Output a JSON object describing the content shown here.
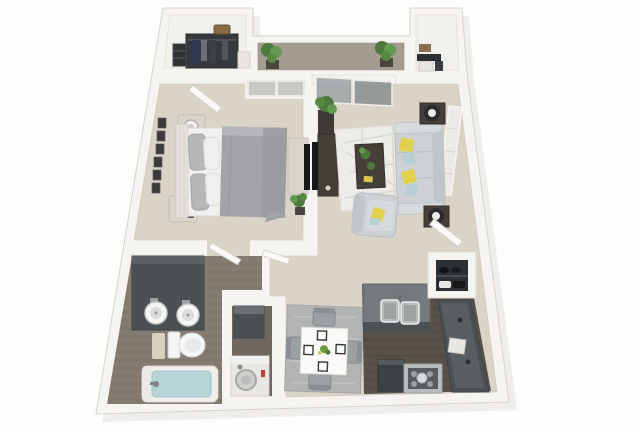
{
  "meta": {
    "description": "3D rendered top-down floor plan of a one-bedroom, one-bathroom apartment with balcony, open living-dining area and U-shaped kitchen",
    "render_style": "photoreal 3D dollhouse floor plan, no visible text"
  },
  "colors": {
    "page_bg": "#fdfdfd",
    "shadow": "#e4e2df",
    "wall": "#f6f4f0",
    "wall_line": "#d7d2cb",
    "floor_main": "#dad3c8",
    "floor_balcony": "#a49c91",
    "floor_bath": "#847c72",
    "floor_bath_line": "#746c62",
    "floor_kitchen": "#57514a",
    "floor_kitchen_line": "#49443e",
    "floor_laundry": "#6e675f",
    "floor_closet": "#f2f0ec",
    "cabinet_dark": "#4b5053",
    "counter_top": "#75797b",
    "wood_dark": "#453f39",
    "console_light": "#d8d4ce",
    "sofa": "#cdd1d3",
    "sofa_trim": "#b9bdbf",
    "cushion_light": "#d6dadc",
    "pillow_yellow": "#e2d14c",
    "pillow_blue": "#b8cfd6",
    "duvet": "#a2a3a6",
    "sheet": "#f1f0ee",
    "headboard": "#e3e0db",
    "rug_living": "#edece9",
    "rug_dining": "#b2b4b3",
    "chair": "#9ba0a3",
    "table_white": "#fbfaf8",
    "plant": "#4d7a3c",
    "plant_light": "#639a4e",
    "pot": "#3f3b37",
    "water": "#b7d4d6",
    "stainless": "#b9bcbd",
    "appliance_dark": "#3c4144",
    "tv": "#17181a",
    "white_goods": "#e9e7e3",
    "red_button": "#c23b35",
    "glass": "#a2a9aa",
    "wardrobe": "#35393c",
    "clothes_navy": "#2e3a52",
    "basket": "#8a6a45",
    "porcelain": "#f6f6f4",
    "door": "#fbfaf7",
    "window_gray": "#c8c8c6"
  },
  "rooms": [
    {
      "id": "walk_in_closet",
      "name": "walk-in closet",
      "items": [
        "wardrobe with hanging clothes",
        "shelf stack",
        "wall basket",
        "storage box"
      ]
    },
    {
      "id": "balcony",
      "name": "balcony",
      "items": [
        "potted plant left",
        "potted plant right"
      ]
    },
    {
      "id": "storage_closet",
      "name": "storage closet",
      "items": [
        "shelf",
        "white box",
        "dark box"
      ]
    },
    {
      "id": "bedroom",
      "name": "bedroom",
      "items": [
        "queen bed with gray duvet",
        "headboard",
        "two nightstands with lamps",
        "wall art frames",
        "media console with tv",
        "floor plant",
        "window",
        "open door"
      ]
    },
    {
      "id": "living_room",
      "name": "living room",
      "items": [
        "sofa with yellow and blue pillows",
        "armchair with yellow pillow",
        "dark coffee table with plants",
        "patterned area rug",
        "media console with tv",
        "two side tables with drum lamps",
        "plant on stand",
        "sliding glass balcony door",
        "window"
      ]
    },
    {
      "id": "bathroom",
      "name": "bathroom",
      "items": [
        "dark double vanity with two round sinks",
        "toilet",
        "bathtub with water",
        "bath mat"
      ]
    },
    {
      "id": "laundry_closet",
      "name": "laundry closet",
      "items": [
        "dark stacked unit",
        "washer with round door and red button"
      ]
    },
    {
      "id": "dining_area",
      "name": "dining area",
      "items": [
        "square white table",
        "four gray chairs",
        "four place settings",
        "green centerpiece",
        "gray rug"
      ]
    },
    {
      "id": "kitchen",
      "name": "kitchen",
      "items": [
        "peninsula counter with double stainless sink",
        "charcoal side counter with appliance",
        "dark refrigerator",
        "range with pots",
        "dark wood floor"
      ]
    },
    {
      "id": "entry",
      "name": "entry",
      "items": [
        "open entry door",
        "shoe closet with shelves"
      ]
    }
  ]
}
